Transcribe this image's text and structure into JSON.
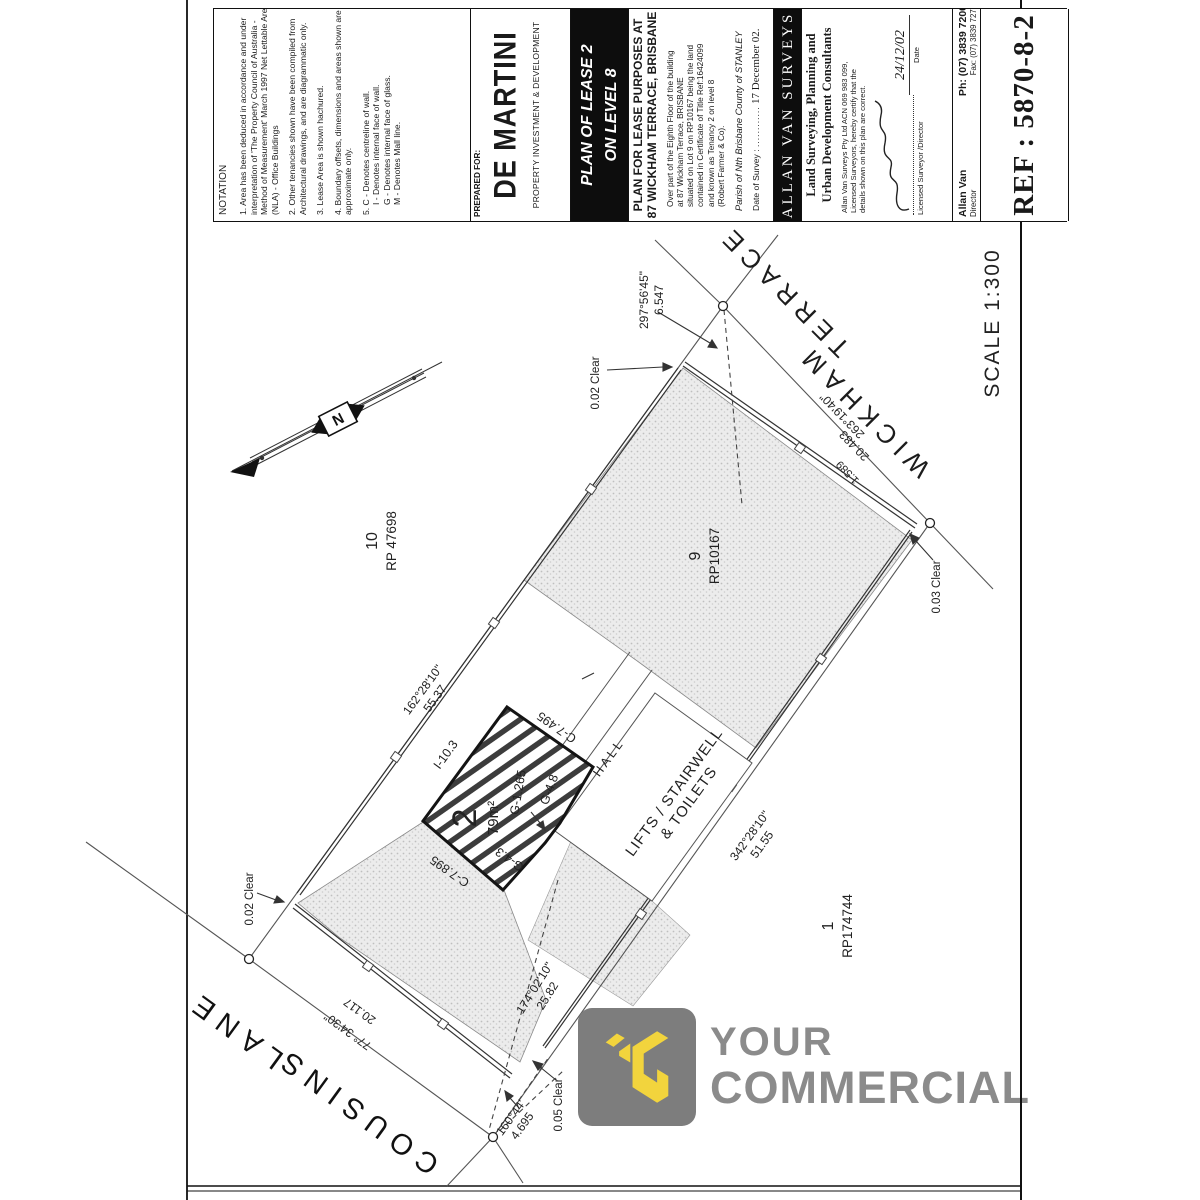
{
  "title_block": {
    "notation": {
      "heading": "NOTATION",
      "notes": [
        "1. Area has been deduced in accordance and under interpretation of 'The Property Council of Australia - Method of Measurement' March 1997 Net Lettable Area (NLA) - Office Buildings",
        "2. Other tenancies shown have been compiled from Architectural drawings, and are diagrammatic only.",
        "3. Lease Area is shown hachured.",
        "4. Boundary offsets, dimensions and areas shown are approximate only.",
        "5. C - Denotes centreline of wall.",
        "I - Denotes internal face of wall.",
        "G - Denotes internal face of glass.",
        "M - Denotes Mall line."
      ]
    },
    "prepared": {
      "label": "PREPARED FOR:",
      "client": "DE MARTINI",
      "client_sub": "PROPERTY INVESTMENT & DEVELOPMENT"
    },
    "plan_title": {
      "line1": "PLAN OF LEASE 2",
      "line2": "ON LEVEL 8"
    },
    "purpose": {
      "heading1": "PLAN FOR LEASE PURPOSES AT",
      "heading2": "87 WICKHAM TERRACE, BRISBANE",
      "desc": [
        "Over part of the Eighth Floor of the building",
        "at 87 Wickham Terrace, BRISBANE",
        "situated on Lot 9 on RP10167 being the land",
        "contained in Certificate of Title Ref:16424099",
        "and known as Tenancy 2 on level 8",
        "(Robert Farmer & Co)."
      ],
      "parish": "Parish of Nth Brisbane   County of STANLEY",
      "date_label": "Date of Survey :",
      "date_dots": "............",
      "date_value": "17 December 02."
    },
    "firm": {
      "banner": "ALLAN VAN SURVEYS",
      "tagline1": "Land Surveying, Planning and",
      "tagline2": "Urban Development Consultants",
      "cert": [
        "Allan Van Surveys Pty Ltd ACN 069 983 099,",
        "Licensed Surveyors, hereby certify that the",
        "details shown on this plan are correct."
      ],
      "signed_label": "Licensed Surveyor /Director",
      "date_handwritten": "24/12/02",
      "date_label": "Date",
      "principal": "Allan Van",
      "principal_role": "Director",
      "phone": "Ph: (07) 3839 7200",
      "fax": "Fax: (07) 3839 7277"
    },
    "ref": {
      "label": "REF : 5870-8-2"
    }
  },
  "plan": {
    "scale": "SCALE 1:300",
    "north_label": "N",
    "streets": {
      "wickham_word1": "WICKHAM",
      "wickham_word2": "TERRACE",
      "cousins_word1": "COUSINS",
      "cousins_word2": "LANE"
    },
    "lots": {
      "lot10": {
        "number": "10",
        "plan": "RP 47698"
      },
      "lot9": {
        "number": "9",
        "plan": "RP10167"
      },
      "lot1": {
        "number": "1",
        "plan": "RP174744"
      }
    },
    "lease": {
      "number": "2",
      "area": "79m²"
    },
    "rooms": {
      "hall": "HALL",
      "lifts_line1": "LIFTS / STAIRWELL",
      "lifts_line2": "& TOILETS"
    },
    "dims": {
      "b1a": "162°28'10\"",
      "b1b": "55.37",
      "b2a": "263°19'40\"",
      "b2b": "20.483",
      "b3a": "342°28'10\"",
      "b3b": "51.55",
      "b4a": "174°02'10\"",
      "b4b": "25.82",
      "b5a": "77° 34'30\"",
      "b5b": "20.117",
      "b6a": "297°56'45\"",
      "b6b": "6.547",
      "b7a": "160°44'",
      "b7b": "4.695",
      "off1": "1.589",
      "clear_002": "0.02 Clear",
      "clear_003": "0.03 Clear",
      "clear_005": "0.05 Clear",
      "e_i103": "I-10.3",
      "e_c7495": "C-7.495",
      "e_c7895": "C-7.895",
      "e_g43": "G-4.3",
      "e_g48": "G-4.8",
      "e_g1265": "G-1.265"
    }
  },
  "watermark": {
    "word1": "YOUR",
    "word2": "COMMERCIAL",
    "square_color": "#7d7d7d",
    "mark_color": "#f2d43d",
    "text_color": "#8b8b8b"
  }
}
